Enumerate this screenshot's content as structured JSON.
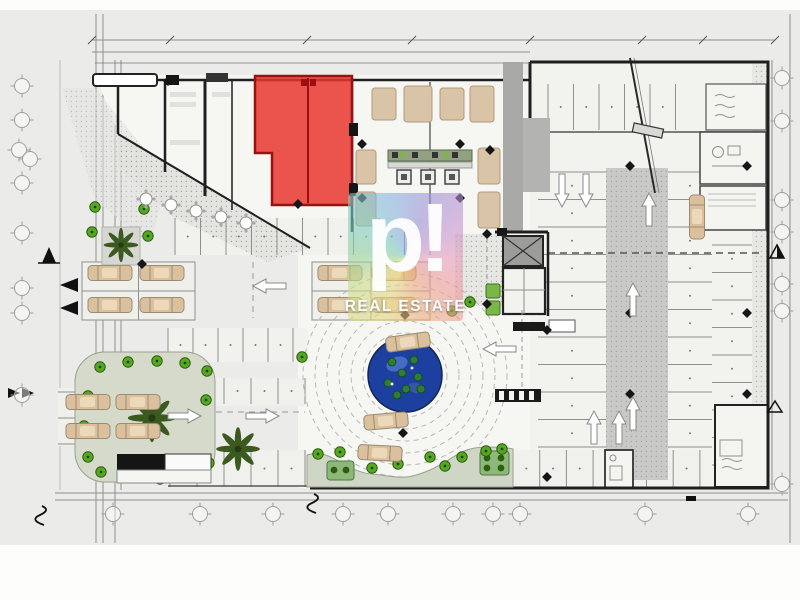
{
  "watermark": {
    "brand_mark": "p!",
    "label": "REAL ESTATE"
  },
  "colors": {
    "background": "#ebebe9",
    "paper": "#f6f6f3",
    "wall": "#1f1f1f",
    "red_unit": "#e8342c",
    "red_unit_border": "#9e0f12",
    "pond": "#1d3fa0",
    "pond_highlight": "#4a74c8",
    "plant": "#2e7d32",
    "shrub": "#55a820",
    "palm": "#3a5a1f",
    "island": "#d5dacb",
    "car": "#dbc09e",
    "car_outline": "#9c8a72",
    "ramp": "#c9c9c7",
    "core": "#a8a8a6",
    "furniture": "#d9c4a8",
    "planter": "#7ab648",
    "watermark_text": "#ffffff"
  },
  "plan": {
    "type": "architectural-site-plan",
    "zones": [
      "street-diagonal-parking",
      "retail-units",
      "highlighted-red-unit",
      "restaurant-seating-area",
      "service-core",
      "stair-core",
      "parking-garage-with-ramp",
      "central-roundabout-plaza",
      "fountain-pond",
      "surface-parking",
      "landscaped-island",
      "grid-reference-bubbles"
    ],
    "counts": {
      "palm_trees": 3,
      "roundabout_cars": 3,
      "parked_cars_left_lot": 12,
      "garage_parked_cars": 1
    }
  }
}
